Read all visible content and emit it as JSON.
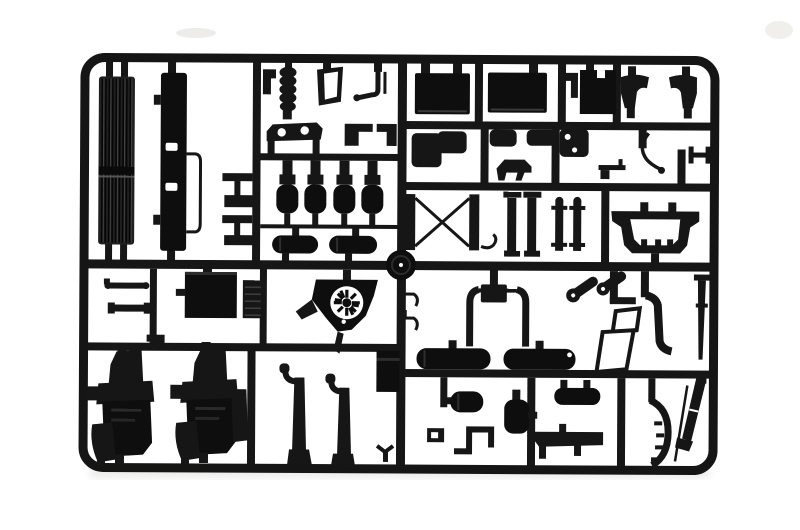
{
  "scene": {
    "description": "Photograph of a black injection-molded plastic model kit sprue (parts tree) with truck chassis components on a white background",
    "visible_text": "none",
    "background_color": "#ffffff",
    "plastic_color": "#161616",
    "plastic_dark": "#0e0e0e",
    "plastic_highlight": "#3a3a3a",
    "shadow_color": "#d8d5d0"
  },
  "sprue": {
    "frame_shape": "rounded-rectangle",
    "runner_thickness_px": 9,
    "sections": [
      "top-left radiator column",
      "top-center small parts",
      "top-right panels and mudguards",
      "mid-left tanks and fan",
      "mid-right crossmembers",
      "bottom-left engine blocks",
      "bottom-right exhaust and mufflers"
    ],
    "parts_inventory": [
      "radiator-grille",
      "bumper-bar",
      "step-bracket-1",
      "step-bracket-2",
      "corner-bracket-small",
      "air-filter-bellows",
      "window-frame",
      "mirror-arm",
      "walking-beam",
      "z-step-bracket",
      "corner-bracket",
      "air-tank-1",
      "air-tank-2",
      "air-tank-3",
      "air-tank-4",
      "horizontal-tank-1",
      "horizontal-tank-2",
      "wiper-arm-1",
      "wiper-arm-2",
      "roof-panel",
      "ribbed-plate",
      "l-bracket",
      "fan-shroud",
      "wheel-disc",
      "panel-1",
      "panel-2",
      "bracket-top",
      "notched-panel",
      "mudguard-left",
      "mudguard-right",
      "floor-bracket",
      "pad-1",
      "pad-2",
      "plate-two-holes",
      "dog-bracket",
      "curved-wire",
      "h-bracket",
      "rod-grip",
      "x-crossmember",
      "hook",
      "channel-pair",
      "leaf-spring-pair",
      "mudflap-arch",
      "hook-wires",
      "exhaust-u-assembly",
      "fuel-tank-1",
      "fuel-tank-2",
      "roller-1",
      "roller-2",
      "jack-stand",
      "j-channel",
      "stack-rod",
      "muffler-1",
      "s-pipe",
      "clamp-bracket",
      "muffler-2",
      "muffler-3",
      "side-skirt",
      "wheel-arch",
      "diagonal-stack",
      "exhaust-pipe-1",
      "exhaust-pipe-2",
      "gearbox-block",
      "v-clip",
      "engine-block-1",
      "engine-block-2"
    ]
  }
}
